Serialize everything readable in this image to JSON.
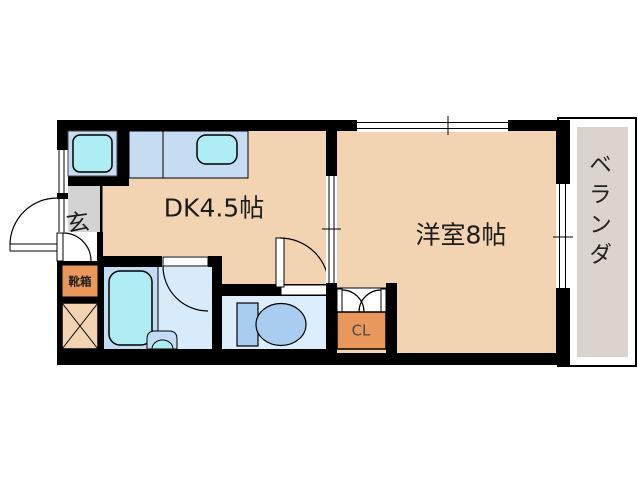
{
  "floorplan": {
    "rooms": {
      "dining_kitchen": {
        "label": "DK4.5帖"
      },
      "western_room": {
        "label": "洋室8帖"
      },
      "entrance": {
        "label": "玄"
      },
      "shoe_cabinet": {
        "label": "靴箱"
      },
      "closet": {
        "label": "CL"
      },
      "veranda": {
        "label": "ベランダ"
      }
    },
    "colors": {
      "wall": "#000000",
      "floor": "#F2D3B2",
      "entrance_gray": "#D3D3D3",
      "veranda_gray": "#DBD4CC",
      "fixture_cyan": "#ADEDF3",
      "counter_blue": "#C6DCF3",
      "bath_floor": "#D8EBFB",
      "bath_panel": "#C2DCF3",
      "toilet_floor": "#DCEDFC",
      "toilet_fixture": "#A9CDF0",
      "accent_orange": "#E9975A",
      "background": "#FFFFFF"
    }
  }
}
